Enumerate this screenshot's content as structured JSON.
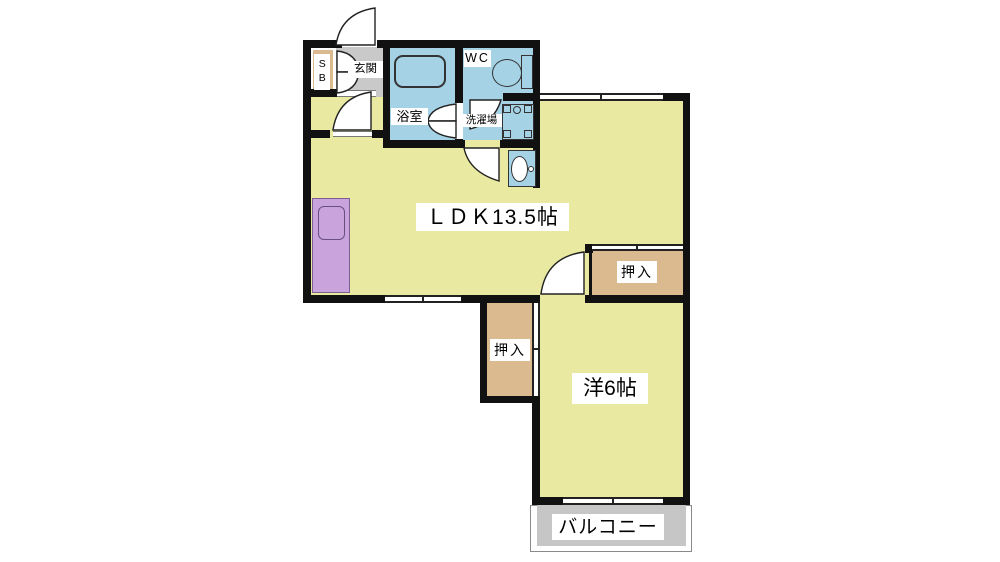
{
  "floorplan": {
    "rooms": {
      "ldk": {
        "label": "ＬＤＫ13.5帖"
      },
      "western_room": {
        "label": "洋6帖"
      },
      "balcony": {
        "label": "バルコニー"
      },
      "entrance": {
        "label": "玄関"
      },
      "bathroom": {
        "label": "浴室"
      },
      "toilet": {
        "label": "WC"
      },
      "laundry": {
        "label": "洗濯場"
      },
      "shoe_box": {
        "label": "SB"
      },
      "closet_upper": {
        "label": "押入"
      },
      "closet_lower": {
        "label": "押入"
      }
    },
    "colors": {
      "room_fill": "#e9e9a2",
      "wet_area_fill": "#a6d2e6",
      "kitchen_counter_fill": "#c9a3dc",
      "closet_fill": "#dcba90",
      "entrance_floor_fill": "#c9c9c9",
      "balcony_fill": "#c6c6c6",
      "wall_color": "#111111"
    }
  }
}
